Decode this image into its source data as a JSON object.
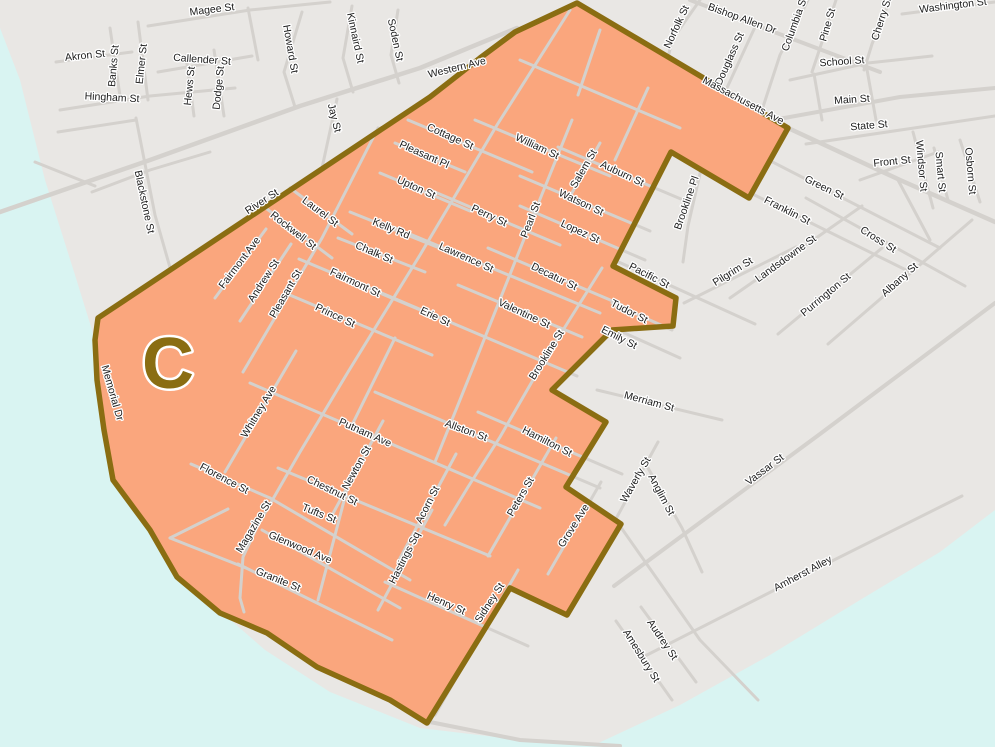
{
  "map": {
    "zone": {
      "text": "C"
    },
    "colors": {
      "land": "#e9e7e4",
      "water": "#d9f4f2",
      "road": "#d4d1cd",
      "zone_fill": "#faa67d",
      "zone_border": "#8a6d12",
      "label_text": "#1c1c1c",
      "label_halo": "#ffffff"
    },
    "street_labels": [
      {
        "t": "Magee St",
        "x": 212,
        "y": 10,
        "r": -7
      },
      {
        "t": "Akron St",
        "x": 85,
        "y": 56,
        "r": -6
      },
      {
        "t": "Banks St",
        "x": 114,
        "y": 66,
        "r": -85
      },
      {
        "t": "Elmer St",
        "x": 142,
        "y": 64,
        "r": -84
      },
      {
        "t": "Callender St",
        "x": 202,
        "y": 60,
        "r": 4
      },
      {
        "t": "Hews St",
        "x": 190,
        "y": 86,
        "r": -84
      },
      {
        "t": "Dodge St",
        "x": 219,
        "y": 88,
        "r": -84
      },
      {
        "t": "Hingham St",
        "x": 112,
        "y": 98,
        "r": 3
      },
      {
        "t": "Howard St",
        "x": 290,
        "y": 49,
        "r": 80
      },
      {
        "t": "Kinnaird St",
        "x": 355,
        "y": 38,
        "r": 78
      },
      {
        "t": "Soden St",
        "x": 395,
        "y": 40,
        "r": 78
      },
      {
        "t": "Jay St",
        "x": 334,
        "y": 118,
        "r": 76
      },
      {
        "t": "Western Ave",
        "x": 457,
        "y": 68,
        "r": -14,
        "s": 11
      },
      {
        "t": "Blackstone St",
        "x": 144,
        "y": 202,
        "r": 78
      },
      {
        "t": "River St",
        "x": 262,
        "y": 202,
        "r": -33
      },
      {
        "t": "Memorial Dr",
        "x": 112,
        "y": 393,
        "r": 74
      },
      {
        "t": "Norfolk St",
        "x": 677,
        "y": 27,
        "r": -65
      },
      {
        "t": "Bishop Allen Dr",
        "x": 742,
        "y": 19,
        "r": 20
      },
      {
        "t": "Douglass St",
        "x": 730,
        "y": 59,
        "r": -66
      },
      {
        "t": "Columbia St",
        "x": 795,
        "y": 24,
        "r": -70
      },
      {
        "t": "Pine St",
        "x": 828,
        "y": 25,
        "r": -74
      },
      {
        "t": "Cherry St",
        "x": 882,
        "y": 19,
        "r": -72
      },
      {
        "t": "Washington St",
        "x": 953,
        "y": 6,
        "r": -7
      },
      {
        "t": "School St",
        "x": 842,
        "y": 62,
        "r": -4
      },
      {
        "t": "Main St",
        "x": 852,
        "y": 100,
        "r": -4
      },
      {
        "t": "State St",
        "x": 869,
        "y": 126,
        "r": -5
      },
      {
        "t": "Front St",
        "x": 892,
        "y": 162,
        "r": -6
      },
      {
        "t": "Windsor St",
        "x": 921,
        "y": 166,
        "r": 85
      },
      {
        "t": "Smart St",
        "x": 940,
        "y": 172,
        "r": 85
      },
      {
        "t": "Osborn St",
        "x": 970,
        "y": 171,
        "r": 85
      },
      {
        "t": "Green St",
        "x": 824,
        "y": 188,
        "r": 26
      },
      {
        "t": "Franklin St",
        "x": 787,
        "y": 211,
        "r": 27
      },
      {
        "t": "Cross St",
        "x": 878,
        "y": 240,
        "r": 32
      },
      {
        "t": "Pilgrim St",
        "x": 733,
        "y": 272,
        "r": -32
      },
      {
        "t": "Landsdowne St",
        "x": 786,
        "y": 259,
        "r": -36
      },
      {
        "t": "Purrington St",
        "x": 826,
        "y": 295,
        "r": -40
      },
      {
        "t": "Albany St",
        "x": 900,
        "y": 280,
        "r": -42
      },
      {
        "t": "Brookline Pl",
        "x": 687,
        "y": 203,
        "r": -71
      },
      {
        "t": "Massachusetts Ave",
        "x": 743,
        "y": 101,
        "r": 28,
        "s": 11
      },
      {
        "t": "Pacific St",
        "x": 649,
        "y": 276,
        "r": 27
      },
      {
        "t": "Tudor St",
        "x": 629,
        "y": 312,
        "r": 27
      },
      {
        "t": "Emily St",
        "x": 619,
        "y": 338,
        "r": 27
      },
      {
        "t": "Merriam St",
        "x": 649,
        "y": 402,
        "r": 15
      },
      {
        "t": "Waverly St",
        "x": 636,
        "y": 480,
        "r": -60
      },
      {
        "t": "Anglim St",
        "x": 661,
        "y": 495,
        "r": 62
      },
      {
        "t": "Vassar St",
        "x": 765,
        "y": 470,
        "r": -37
      },
      {
        "t": "Amherst Alley",
        "x": 803,
        "y": 574,
        "r": -28
      },
      {
        "t": "Audrey St",
        "x": 662,
        "y": 640,
        "r": 56
      },
      {
        "t": "Amesbury St",
        "x": 641,
        "y": 656,
        "r": 58
      },
      {
        "t": "Cottage St",
        "x": 450,
        "y": 137,
        "r": 24
      },
      {
        "t": "Pleasant Pl",
        "x": 424,
        "y": 155,
        "r": 24
      },
      {
        "t": "Upton St",
        "x": 416,
        "y": 188,
        "r": 24
      },
      {
        "t": "William St",
        "x": 537,
        "y": 147,
        "r": 25
      },
      {
        "t": "Salem St",
        "x": 584,
        "y": 169,
        "r": -60
      },
      {
        "t": "Auburn St",
        "x": 622,
        "y": 174,
        "r": 25
      },
      {
        "t": "Watson St",
        "x": 581,
        "y": 203,
        "r": 25
      },
      {
        "t": "Lopez St",
        "x": 580,
        "y": 232,
        "r": 25
      },
      {
        "t": "Perry St",
        "x": 489,
        "y": 216,
        "r": 25
      },
      {
        "t": "Pearl St",
        "x": 531,
        "y": 220,
        "r": -69
      },
      {
        "t": "Kelly Rd",
        "x": 391,
        "y": 229,
        "r": 22
      },
      {
        "t": "Chalk St",
        "x": 374,
        "y": 253,
        "r": 23
      },
      {
        "t": "Laurel St",
        "x": 320,
        "y": 212,
        "r": 37
      },
      {
        "t": "Rockwell St",
        "x": 293,
        "y": 231,
        "r": 38
      },
      {
        "t": "Fairmont Ave",
        "x": 240,
        "y": 263,
        "r": -53
      },
      {
        "t": "Andrew St",
        "x": 264,
        "y": 281,
        "r": -57
      },
      {
        "t": "Pleasant St",
        "x": 286,
        "y": 294,
        "r": -60
      },
      {
        "t": "Fairmont St",
        "x": 355,
        "y": 283,
        "r": 25
      },
      {
        "t": "Prince St",
        "x": 335,
        "y": 316,
        "r": 25
      },
      {
        "t": "Lawrence St",
        "x": 466,
        "y": 258,
        "r": 24
      },
      {
        "t": "Decatur St",
        "x": 554,
        "y": 277,
        "r": 26
      },
      {
        "t": "Valentine St",
        "x": 524,
        "y": 314,
        "r": 25
      },
      {
        "t": "Erie St",
        "x": 435,
        "y": 317,
        "r": 25
      },
      {
        "t": "Brookline St",
        "x": 547,
        "y": 355,
        "r": -58
      },
      {
        "t": "Whitney Ave",
        "x": 259,
        "y": 412,
        "r": -59
      },
      {
        "t": "Putnam Ave",
        "x": 365,
        "y": 433,
        "r": 24
      },
      {
        "t": "Newton St",
        "x": 357,
        "y": 468,
        "r": -61
      },
      {
        "t": "Chestnut St",
        "x": 332,
        "y": 491,
        "r": 26
      },
      {
        "t": "Tufts St",
        "x": 319,
        "y": 514,
        "r": 22
      },
      {
        "t": "Florence St",
        "x": 224,
        "y": 479,
        "r": 28
      },
      {
        "t": "Magazine St",
        "x": 254,
        "y": 527,
        "r": -59
      },
      {
        "t": "Glenwood Ave",
        "x": 300,
        "y": 548,
        "r": 23
      },
      {
        "t": "Granite St",
        "x": 278,
        "y": 580,
        "r": 22
      },
      {
        "t": "Acorn St",
        "x": 428,
        "y": 505,
        "r": -63
      },
      {
        "t": "Hastings Sq",
        "x": 405,
        "y": 558,
        "r": -63
      },
      {
        "t": "Henry St",
        "x": 446,
        "y": 604,
        "r": 24
      },
      {
        "t": "Sidney St",
        "x": 490,
        "y": 603,
        "r": -57
      },
      {
        "t": "Allston St",
        "x": 466,
        "y": 431,
        "r": 20
      },
      {
        "t": "Hamilton St",
        "x": 547,
        "y": 442,
        "r": 27
      },
      {
        "t": "Peters St",
        "x": 521,
        "y": 497,
        "r": -60
      },
      {
        "t": "Grove Ave",
        "x": 574,
        "y": 526,
        "r": -58
      }
    ]
  }
}
